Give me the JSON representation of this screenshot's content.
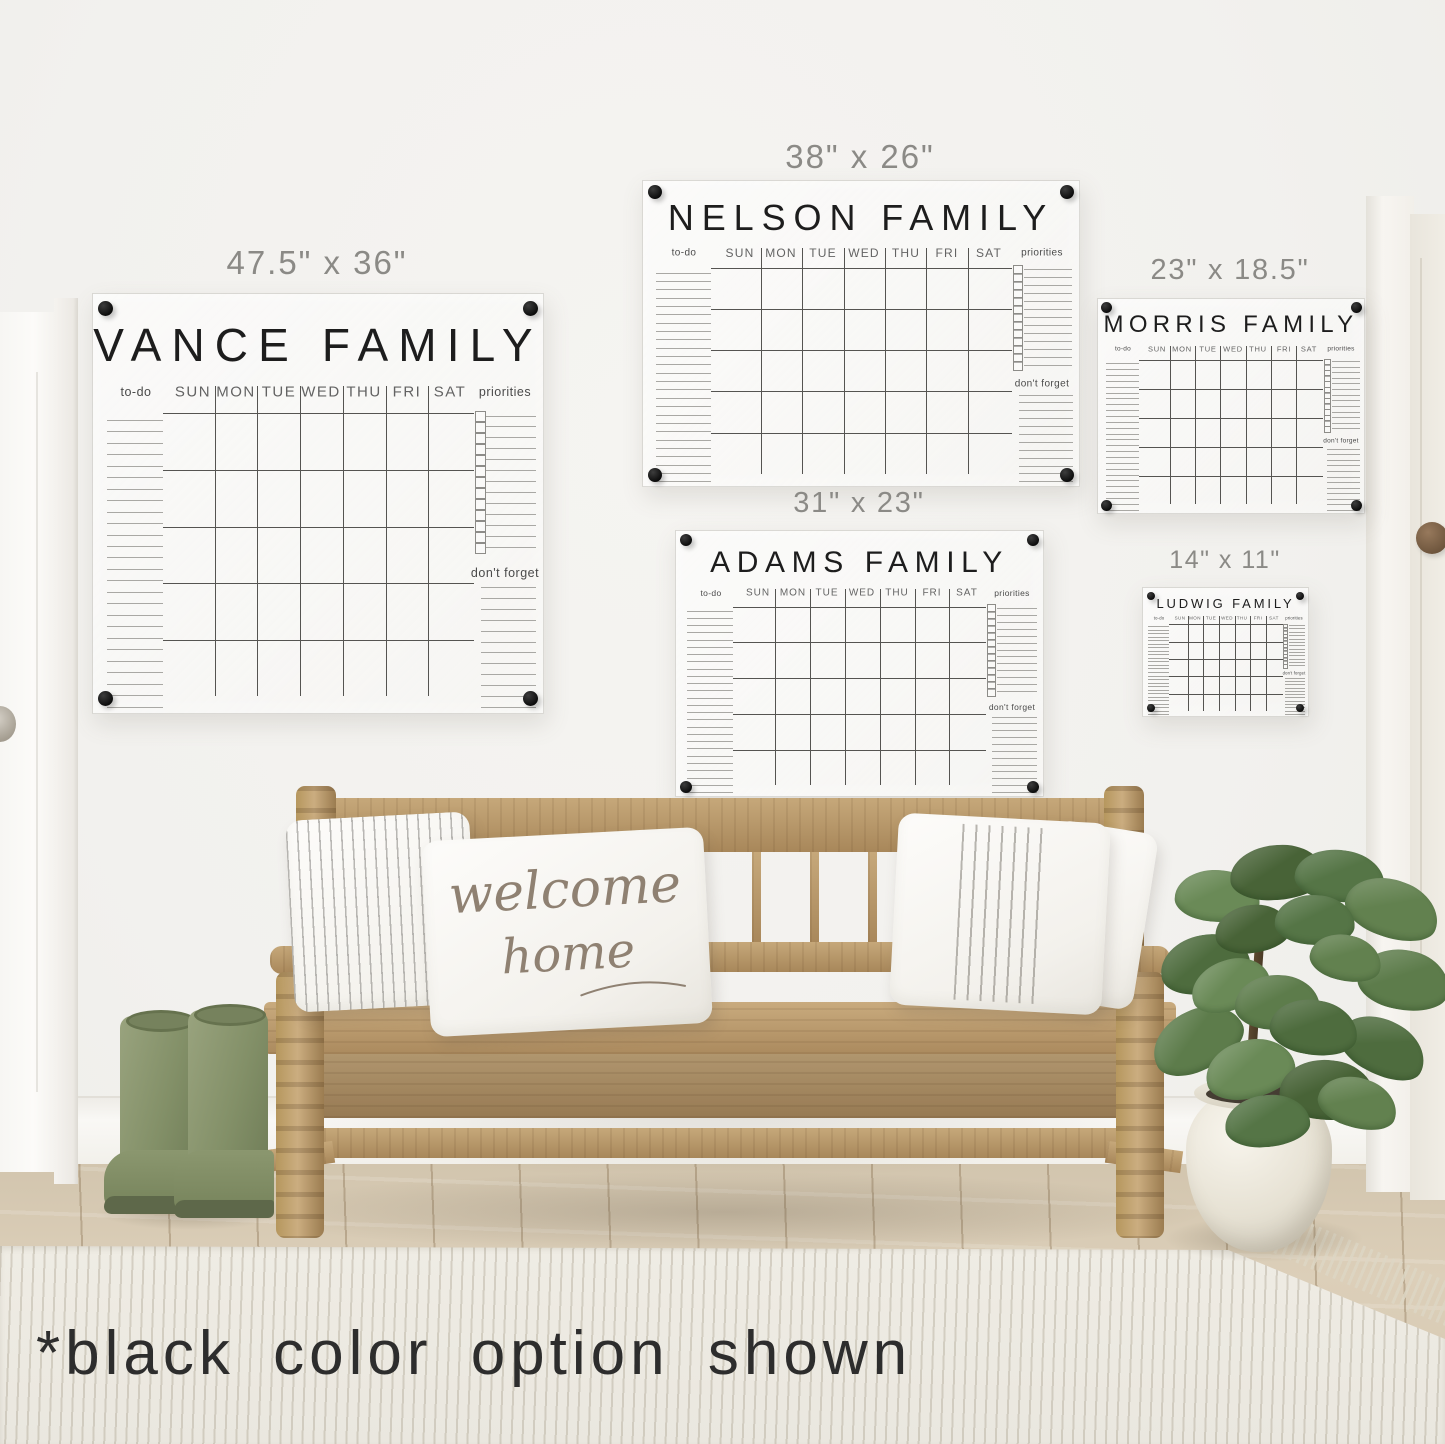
{
  "caption": "*black color option shown",
  "labels": {
    "todo": "to-do",
    "priorities": "priorities",
    "dont_forget": "don't forget"
  },
  "days": [
    "SUN",
    "MON",
    "TUE",
    "WED",
    "THU",
    "FRI",
    "SAT"
  ],
  "calendars": [
    {
      "id": "vance",
      "name": "VANCE FAMILY",
      "size": "47.5\" x 36\""
    },
    {
      "id": "nelson",
      "name": "NELSON FAMILY",
      "size": "38\" x 26\""
    },
    {
      "id": "morris",
      "name": "MORRIS FAMILY",
      "size": "23\" x 18.5\""
    },
    {
      "id": "adams",
      "name": "ADAMS FAMILY",
      "size": "31\" x 23\""
    },
    {
      "id": "ludwig",
      "name": "LUDWIG FAMILY",
      "size": "14\" x 11\""
    }
  ],
  "pillow": {
    "line1": "welcome",
    "line2": "home"
  },
  "colors": {
    "wall": "#f2f1ee",
    "screw": "#141414",
    "board_line": "#555451",
    "accent_text": "#1d1d1d",
    "boot_green": "#839068",
    "leaf_green": "#5d7c4b"
  }
}
